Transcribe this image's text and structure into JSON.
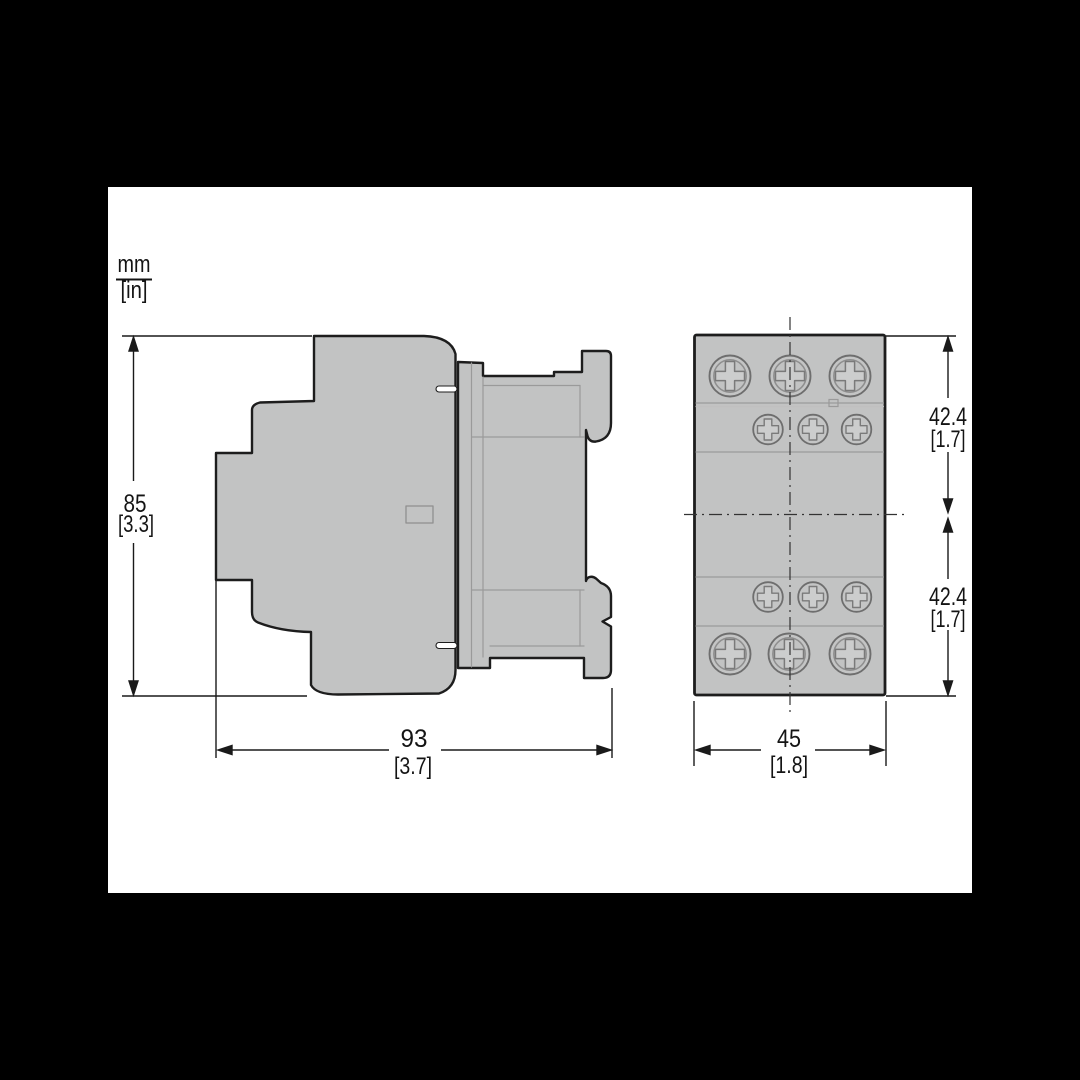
{
  "units_label": {
    "top": "mm",
    "bottom": "[in]"
  },
  "side_view": {
    "height_dim": {
      "mm": "85",
      "in": "[3.3]"
    },
    "width_dim": {
      "mm": "93",
      "in": "[3.7]"
    }
  },
  "front_view": {
    "upper_dim": {
      "mm": "42.4",
      "in": "[1.7]"
    },
    "lower_dim": {
      "mm": "42.4",
      "in": "[1.7]"
    },
    "width_dim": {
      "mm": "45",
      "in": "[1.8]"
    }
  },
  "colors": {
    "sheet_background": "#ffffff",
    "page_background": "#000000",
    "body_fill": "#c2c3c3",
    "outline": "#1d1d1d",
    "seam_line": "#9a9a9a",
    "screw_stroke": "#6e6e6e",
    "dimension_ink": "#1a1a1a"
  }
}
